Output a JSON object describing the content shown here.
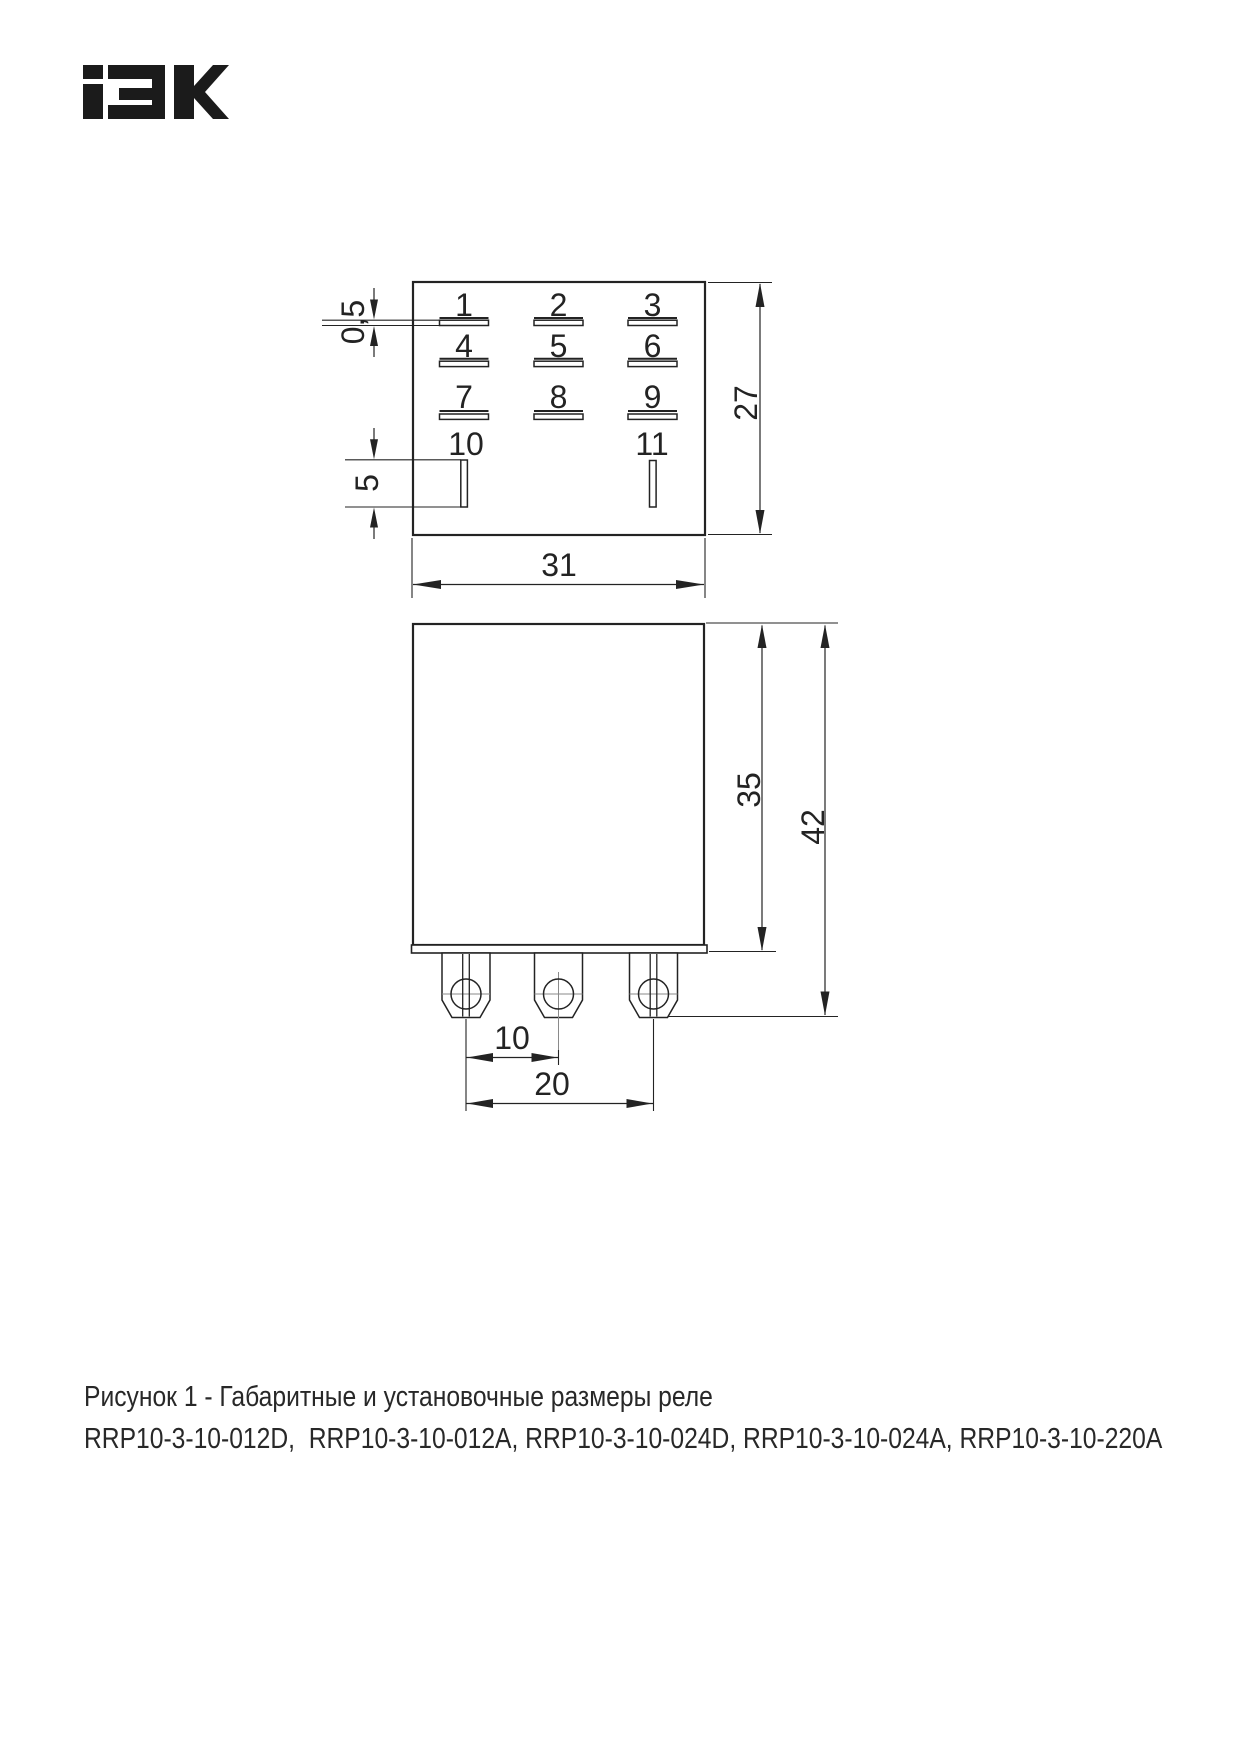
{
  "brand": {
    "logo_text": "IEK"
  },
  "drawing": {
    "top_view": {
      "grid_pins": [
        "1",
        "2",
        "3",
        "4",
        "5",
        "6",
        "7",
        "8",
        "9"
      ],
      "bottom_pins": [
        "10",
        "11"
      ],
      "dim_slot_thickness": "0,5",
      "dim_slot_length": "5",
      "dim_depth": "27",
      "dim_width": "31"
    },
    "front_view": {
      "dim_body_height": "35",
      "dim_overall_height": "42",
      "dim_pin_pitch": "10",
      "dim_outer_pin_span": "20"
    }
  },
  "caption": {
    "line1": "Рисунок 1 - Габаритные и установочные размеры реле",
    "line2": "RRP10-3-10-012D,  RRP10-3-10-012A, RRP10-3-10-024D, RRP10-3-10-024A, RRP10-3-10-220A"
  },
  "colors": {
    "ink": "#232323",
    "centerline": "#8a8a8a",
    "background": "#ffffff"
  }
}
